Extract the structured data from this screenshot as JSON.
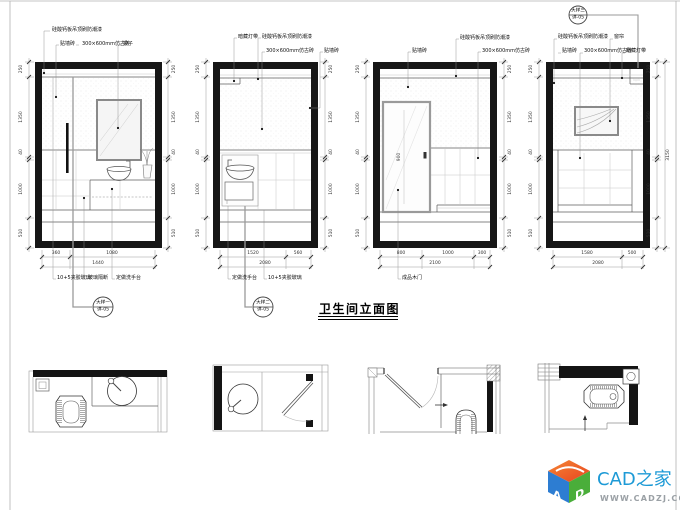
{
  "sheet": {
    "title": "卫生间立面图"
  },
  "detail_refs": [
    {
      "line1": "大样一",
      "line2": "详-05"
    },
    {
      "line1": "大样二",
      "line2": "详-05"
    },
    {
      "line1": "大样三",
      "line2": "详-05"
    }
  ],
  "elevations": [
    {
      "top_labels": [
        "硅酸钙板吊顶刷防潮漆",
        "贴墙砖",
        "300×600mm仿古砖",
        "镜子"
      ],
      "bottom_labels": [
        "10+5夹胶玻璃",
        "玻璃隔断",
        "定做洗手台"
      ],
      "dims_vertical": [
        "250",
        "1350",
        "40",
        "1000",
        "510"
      ],
      "dims_bottom": [
        "360",
        "1080"
      ],
      "dims_total": [
        "1440"
      ]
    },
    {
      "top_labels": [
        "暗藏灯带",
        "硅酸钙板吊顶刷防潮漆",
        "300×600mm仿古砖",
        "贴墙砖"
      ],
      "bottom_labels": [
        "定做洗手台",
        "10+5夹胶玻璃"
      ],
      "dims_vertical": [
        "250",
        "1350",
        "40",
        "1000",
        "510"
      ],
      "dims_bottom": [
        "1520",
        "560"
      ],
      "dims_total": [
        "2080"
      ]
    },
    {
      "top_labels": [
        "贴墙砖",
        "硅酸钙板吊顶刷防潮漆",
        "300×600mm仿古砖"
      ],
      "bottom_labels": [
        "成品木门"
      ],
      "door_width_dim": "900",
      "dims_vertical": [
        "250",
        "1350",
        "40",
        "1000",
        "510"
      ],
      "dims_bottom": [
        "800",
        "1000",
        "300"
      ],
      "dims_total": [
        "2100"
      ]
    },
    {
      "top_labels": [
        "硅酸钙板吊顶刷防潮漆",
        "贴墙砖",
        "300×600mm仿古砖",
        "窗帘",
        "暗藏灯带"
      ],
      "bottom_labels": [],
      "dims_vertical": [
        "250",
        "1350",
        "40",
        "1000",
        "510"
      ],
      "dims_bottom": [
        "1580",
        "500"
      ],
      "dims_total": [
        "2080"
      ],
      "dims_overall": "3150"
    }
  ],
  "logo": {
    "brand": "CAD之家",
    "url": "WWW.CADZJ.COM",
    "cube_letters": {
      "left": "A",
      "right": "D"
    },
    "colors": {
      "brand_blue": "#1d9ad6",
      "url_gray": "#9aa0a5",
      "cube_orange": "#ed6a21",
      "cube_blue": "#2d7dd2",
      "cube_green": "#4aae3a"
    }
  }
}
